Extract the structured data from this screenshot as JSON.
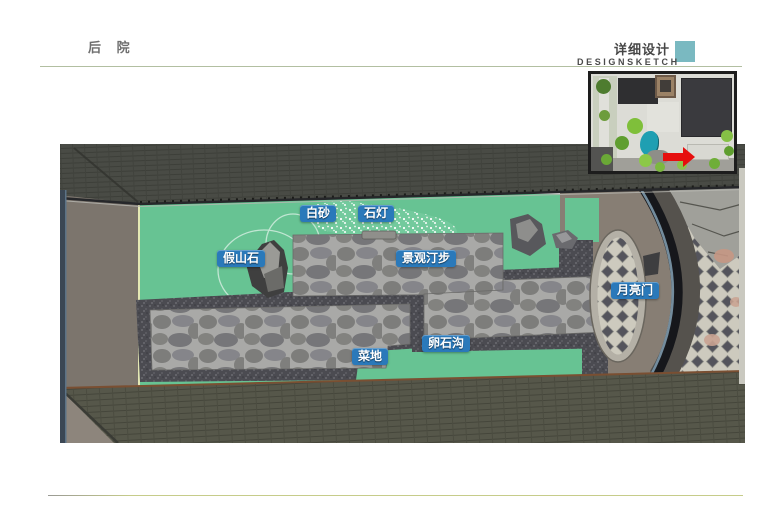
{
  "header": {
    "section_title": "后 院",
    "right_title": "详细设计",
    "right_subtitle": "DESIGNSKETCH",
    "accent_square_color": "#7ab9c1",
    "top_line_color": "#b2bfa1",
    "bottom_line_color": "#c6cc8a"
  },
  "main": {
    "annotations": [
      {
        "text": "白砂"
      },
      {
        "text": "石灯"
      },
      {
        "text": "假山石"
      },
      {
        "text": "景观汀步"
      },
      {
        "text": "月亮门"
      },
      {
        "text": "卵石沟"
      },
      {
        "text": "菜地"
      }
    ],
    "label_color": "#2a79ba",
    "colors": {
      "lawn": "#67c393",
      "flagstone": "#828280",
      "pebble_ditch": "#4b4b51",
      "roof_top": "#494b45",
      "roof_bottom": "#56574a",
      "side_wall": "#7c756d",
      "courtyard_ground": "#877e74",
      "moon_gate_ring": "#16171b",
      "diamond_paving": "#cdcabe"
    }
  },
  "inset": {
    "arrow_color": "#e60e0e",
    "pond_color": "#1f9fb2"
  }
}
